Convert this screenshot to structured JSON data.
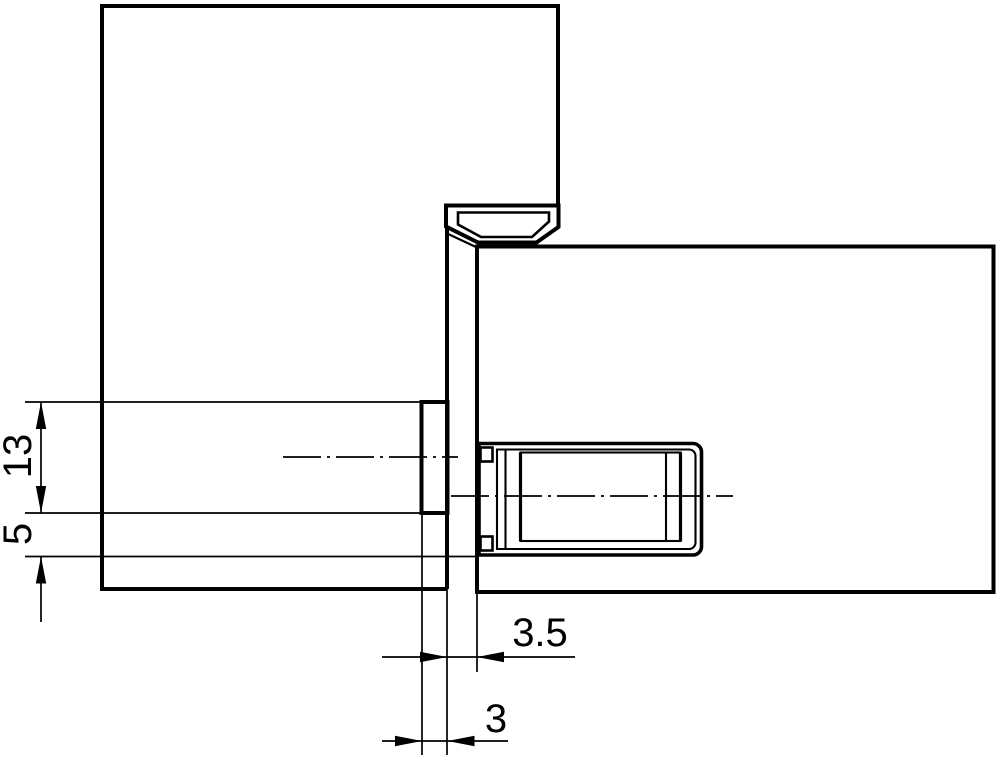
{
  "drawing": {
    "background": "#ffffff",
    "line_color": "#000000",
    "dimensions": {
      "d13": {
        "label": "13"
      },
      "d5": {
        "label": "5"
      },
      "d35": {
        "label": "3.5"
      },
      "d3": {
        "label": "3"
      }
    }
  }
}
